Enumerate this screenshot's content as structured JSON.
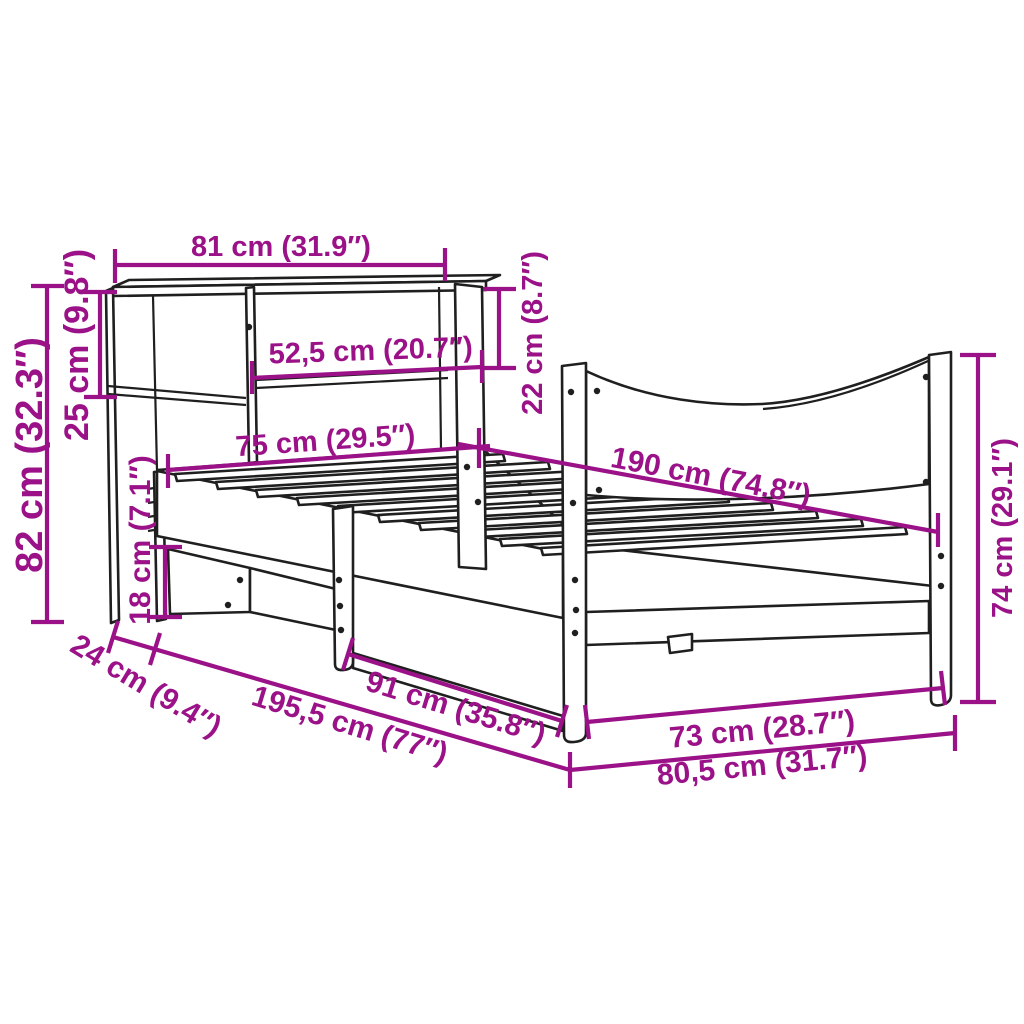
{
  "page": {
    "title": "Bed frame with bookshelf headboard — dimension diagram",
    "background": "#ffffff"
  },
  "style": {
    "dimension_color": "#9B1188",
    "drawing_color": "#1f1f1f"
  },
  "product": {
    "type": "bed frame with bookshelf headboard, slatted base and curved footboard"
  },
  "dimensions": {
    "headboard_shelf_width": {
      "label": "81 cm (31.9″)",
      "cm": 81,
      "inches": 31.9
    },
    "shelf_opening_width": {
      "label": "52,5 cm (20.7″)",
      "cm": 52.5,
      "inches": 20.7
    },
    "shelf_opening_height": {
      "label": "22 cm (8.7″)",
      "cm": 22,
      "inches": 8.7
    },
    "top_shelf_height": {
      "label": "25 cm (9.8″)",
      "cm": 25,
      "inches": 9.8
    },
    "headboard_total_height": {
      "label": "82 cm (32.3″)",
      "cm": 82,
      "inches": 32.3
    },
    "bed_width": {
      "label": "75 cm (29.5″)",
      "cm": 75,
      "inches": 29.5
    },
    "bed_length": {
      "label": "190 cm (74.8″)",
      "cm": 190,
      "inches": 74.8
    },
    "footboard_height": {
      "label": "74 cm (29.1″)",
      "cm": 74,
      "inches": 29.1
    },
    "headboard_base_height": {
      "label": "18 cm (7.1″)",
      "cm": 18,
      "inches": 7.1
    },
    "headboard_depth": {
      "label": "24 cm (9.4″)",
      "cm": 24,
      "inches": 9.4
    },
    "total_length": {
      "label": "195,5 cm (77″)",
      "cm": 195.5,
      "inches": 77
    },
    "side_rail_length": {
      "label": "91 cm (35.8″)",
      "cm": 91,
      "inches": 35.8
    },
    "footboard_inner_width": {
      "label": "73 cm (28.7″)",
      "cm": 73,
      "inches": 28.7
    },
    "total_width": {
      "label": "80,5 cm (31.7″)",
      "cm": 80.5,
      "inches": 31.7
    }
  }
}
